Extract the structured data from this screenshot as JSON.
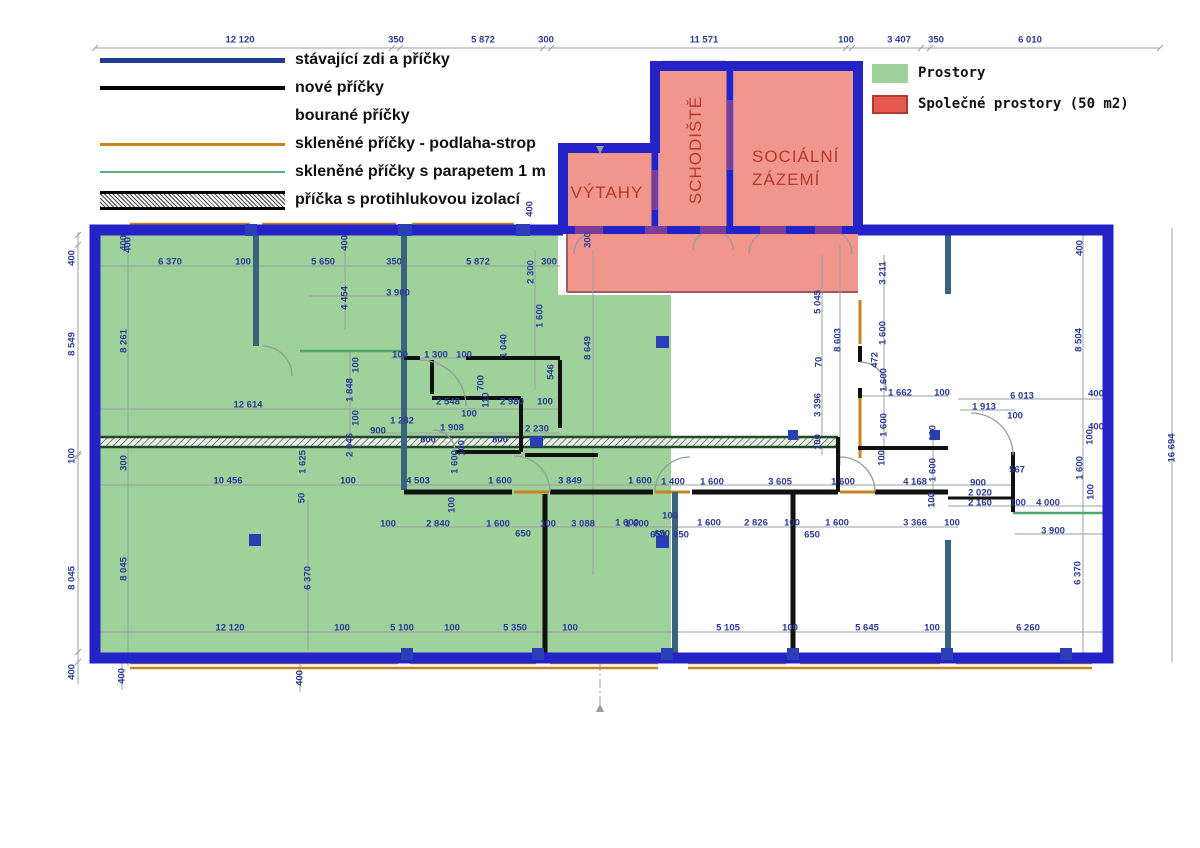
{
  "title": "Floor plan with partitions legend",
  "colors": {
    "wall_existing": "#2323c8",
    "wall_interior": "#3a647e",
    "wall_new": "#111111",
    "wall_purple": "#7d3c98",
    "glass_full": "#c8821e",
    "glass_parapet": "#4aa56e",
    "area_units_fill": "#9fd19a",
    "area_common_fill": "#f0968c",
    "area_common_swatch": "#e4584e",
    "dim_text": "#2b3a96",
    "room_label": "#b53a2c"
  },
  "legend_walls": {
    "items": [
      {
        "label": "stávající zdi a příčky",
        "swatch": "existing"
      },
      {
        "label": "nové příčky",
        "swatch": "new"
      },
      {
        "label": "bourané příčky",
        "swatch": "none"
      },
      {
        "label": "skleněné příčky - podlaha-strop",
        "swatch": "glass-full"
      },
      {
        "label": "skleněné příčky s parapetem 1 m",
        "swatch": "glass-parapet"
      },
      {
        "label": "příčka s protihlukovou izolací",
        "swatch": "acoustic"
      }
    ]
  },
  "legend_areas": {
    "items": [
      {
        "label": "Prostory",
        "fill": "#9fd19a",
        "border": "#9fd19a"
      },
      {
        "label": "Společné prostory (50 m2)",
        "fill": "#e4584e",
        "border": "#b03a30"
      }
    ]
  },
  "rooms": {
    "elevators": "VÝTAHY",
    "staircase": "SCHODIŠTĚ",
    "facilities_line1": "SOCIÁLNÍ",
    "facilities_line2": "ZÁZEMÍ"
  },
  "dims": [
    [
      "12 120",
      240,
      40,
      0
    ],
    [
      "350",
      396,
      40,
      0
    ],
    [
      "5 872",
      483,
      40,
      0
    ],
    [
      "300",
      546,
      40,
      0
    ],
    [
      "11 571",
      704,
      40,
      0
    ],
    [
      "100",
      846,
      40,
      0
    ],
    [
      "3 407",
      899,
      40,
      0
    ],
    [
      "350",
      936,
      40,
      0
    ],
    [
      "6 010",
      1030,
      40,
      0
    ],
    [
      "400",
      72,
      258,
      1
    ],
    [
      "8 549",
      72,
      344,
      1
    ],
    [
      "100",
      72,
      456,
      1
    ],
    [
      "8 045",
      72,
      578,
      1
    ],
    [
      "400",
      72,
      672,
      1
    ],
    [
      "400",
      124,
      243,
      1
    ],
    [
      "8 261",
      124,
      341,
      1
    ],
    [
      "300",
      124,
      463,
      1
    ],
    [
      "8 045",
      124,
      569,
      1
    ],
    [
      "400",
      122,
      676,
      1
    ],
    [
      "400",
      300,
      678,
      1
    ],
    [
      "16 694",
      1172,
      448,
      1
    ],
    [
      "400",
      1080,
      248,
      1
    ],
    [
      "8 504",
      1079,
      340,
      1
    ],
    [
      "400",
      1096,
      394,
      0
    ],
    [
      "400",
      1096,
      427,
      0
    ],
    [
      "100",
      1090,
      437,
      1
    ],
    [
      "1 600",
      1080,
      468,
      1
    ],
    [
      "100",
      1091,
      492,
      1
    ],
    [
      "6 370",
      1078,
      573,
      1
    ],
    [
      "400",
      128,
      245,
      1
    ],
    [
      "6 370",
      170,
      262,
      0
    ],
    [
      "100",
      243,
      262,
      0
    ],
    [
      "5 650",
      323,
      262,
      0
    ],
    [
      "350",
      394,
      262,
      0
    ],
    [
      "400",
      345,
      243,
      1
    ],
    [
      "5 872",
      478,
      262,
      0
    ],
    [
      "2 300",
      531,
      272,
      1
    ],
    [
      "300",
      549,
      262,
      0
    ],
    [
      "400",
      530,
      209,
      1
    ],
    [
      "4 454",
      345,
      298,
      1
    ],
    [
      "3 900",
      398,
      293,
      0
    ],
    [
      "1 600",
      540,
      316,
      1
    ],
    [
      "1 040",
      504,
      346,
      1
    ],
    [
      "546",
      551,
      372,
      1
    ],
    [
      "300",
      588,
      240,
      1
    ],
    [
      "8 649",
      588,
      348,
      1
    ],
    [
      "100",
      400,
      355,
      0
    ],
    [
      "1 300",
      436,
      355,
      0
    ],
    [
      "100",
      464,
      355,
      0
    ],
    [
      "700",
      481,
      383,
      1
    ],
    [
      "1 848",
      350,
      390,
      1
    ],
    [
      "100",
      356,
      365,
      1
    ],
    [
      "100",
      356,
      418,
      1
    ],
    [
      "12 614",
      248,
      405,
      0
    ],
    [
      "2 548",
      448,
      402,
      0
    ],
    [
      "110",
      486,
      400,
      1
    ],
    [
      "2 980",
      512,
      402,
      0
    ],
    [
      "100",
      545,
      402,
      0
    ],
    [
      "100",
      469,
      414,
      0
    ],
    [
      "1 282",
      402,
      421,
      0
    ],
    [
      "900",
      378,
      431,
      0
    ],
    [
      "1 908",
      452,
      428,
      0
    ],
    [
      "100",
      462,
      448,
      1
    ],
    [
      "800",
      428,
      440,
      0
    ],
    [
      "800",
      500,
      440,
      0
    ],
    [
      "2 230",
      537,
      429,
      0
    ],
    [
      "2 046",
      350,
      445,
      1
    ],
    [
      "1 625",
      303,
      462,
      1
    ],
    [
      "50",
      302,
      498,
      1
    ],
    [
      "10 456",
      228,
      481,
      0
    ],
    [
      "100",
      348,
      481,
      0
    ],
    [
      "4 503",
      418,
      481,
      0
    ],
    [
      "1 600",
      455,
      462,
      1
    ],
    [
      "100",
      452,
      505,
      1
    ],
    [
      "1 600",
      500,
      481,
      0
    ],
    [
      "3 849",
      570,
      481,
      0
    ],
    [
      "1 600",
      640,
      481,
      0
    ],
    [
      "1 400",
      673,
      482,
      0
    ],
    [
      "1 600",
      712,
      482,
      0
    ],
    [
      "3 605",
      780,
      482,
      0
    ],
    [
      "1 600",
      843,
      482,
      0
    ],
    [
      "4 168",
      915,
      482,
      0
    ],
    [
      "1 600",
      933,
      470,
      1
    ],
    [
      "900",
      978,
      483,
      0
    ],
    [
      "567",
      1017,
      470,
      0
    ],
    [
      "2 020",
      980,
      493,
      0
    ],
    [
      "2 160",
      980,
      503,
      0
    ],
    [
      "100",
      932,
      500,
      1
    ],
    [
      "100",
      1018,
      503,
      0
    ],
    [
      "4 000",
      1048,
      503,
      0
    ],
    [
      "1 600",
      627,
      523,
      0
    ],
    [
      "100",
      670,
      516,
      0
    ],
    [
      "650",
      658,
      535,
      0
    ],
    [
      "650",
      681,
      535,
      0
    ],
    [
      "1 600",
      709,
      523,
      0
    ],
    [
      "2 826",
      756,
      523,
      0
    ],
    [
      "100",
      792,
      523,
      0
    ],
    [
      "650",
      812,
      535,
      0
    ],
    [
      "1 600",
      837,
      523,
      0
    ],
    [
      "3 366",
      915,
      523,
      0
    ],
    [
      "100",
      952,
      523,
      0
    ],
    [
      "3 900",
      1053,
      531,
      0
    ],
    [
      "100",
      388,
      524,
      0
    ],
    [
      "2 840",
      438,
      524,
      0
    ],
    [
      "1 600",
      498,
      524,
      0
    ],
    [
      "650",
      523,
      534,
      0
    ],
    [
      "100",
      548,
      524,
      0
    ],
    [
      "3 088",
      583,
      524,
      0
    ],
    [
      "1 600",
      637,
      524,
      0
    ],
    [
      "650",
      662,
      534,
      0
    ],
    [
      "5 045",
      818,
      302,
      1
    ],
    [
      "8 603",
      838,
      340,
      1
    ],
    [
      "3 211",
      883,
      273,
      1
    ],
    [
      "1 600",
      883,
      333,
      1
    ],
    [
      "472",
      875,
      360,
      1
    ],
    [
      "70",
      819,
      362,
      1
    ],
    [
      "1 600",
      884,
      380,
      1
    ],
    [
      "1 600",
      884,
      425,
      1
    ],
    [
      "3 396",
      818,
      405,
      1
    ],
    [
      "100",
      818,
      442,
      1
    ],
    [
      "1 662",
      900,
      393,
      0
    ],
    [
      "100",
      942,
      393,
      0
    ],
    [
      "100",
      933,
      433,
      1
    ],
    [
      "100",
      882,
      458,
      1
    ],
    [
      "6 013",
      1022,
      396,
      0
    ],
    [
      "1 913",
      984,
      407,
      0
    ],
    [
      "100",
      1015,
      416,
      0
    ],
    [
      "12 120",
      230,
      628,
      0
    ],
    [
      "100",
      342,
      628,
      0
    ],
    [
      "5 100",
      402,
      628,
      0
    ],
    [
      "100",
      452,
      628,
      0
    ],
    [
      "5 350",
      515,
      628,
      0
    ],
    [
      "100",
      570,
      628,
      0
    ],
    [
      "5 105",
      728,
      628,
      0
    ],
    [
      "100",
      790,
      628,
      0
    ],
    [
      "5 645",
      867,
      628,
      0
    ],
    [
      "100",
      932,
      628,
      0
    ],
    [
      "6 260",
      1028,
      628,
      0
    ],
    [
      "6 370",
      308,
      578,
      1
    ]
  ]
}
